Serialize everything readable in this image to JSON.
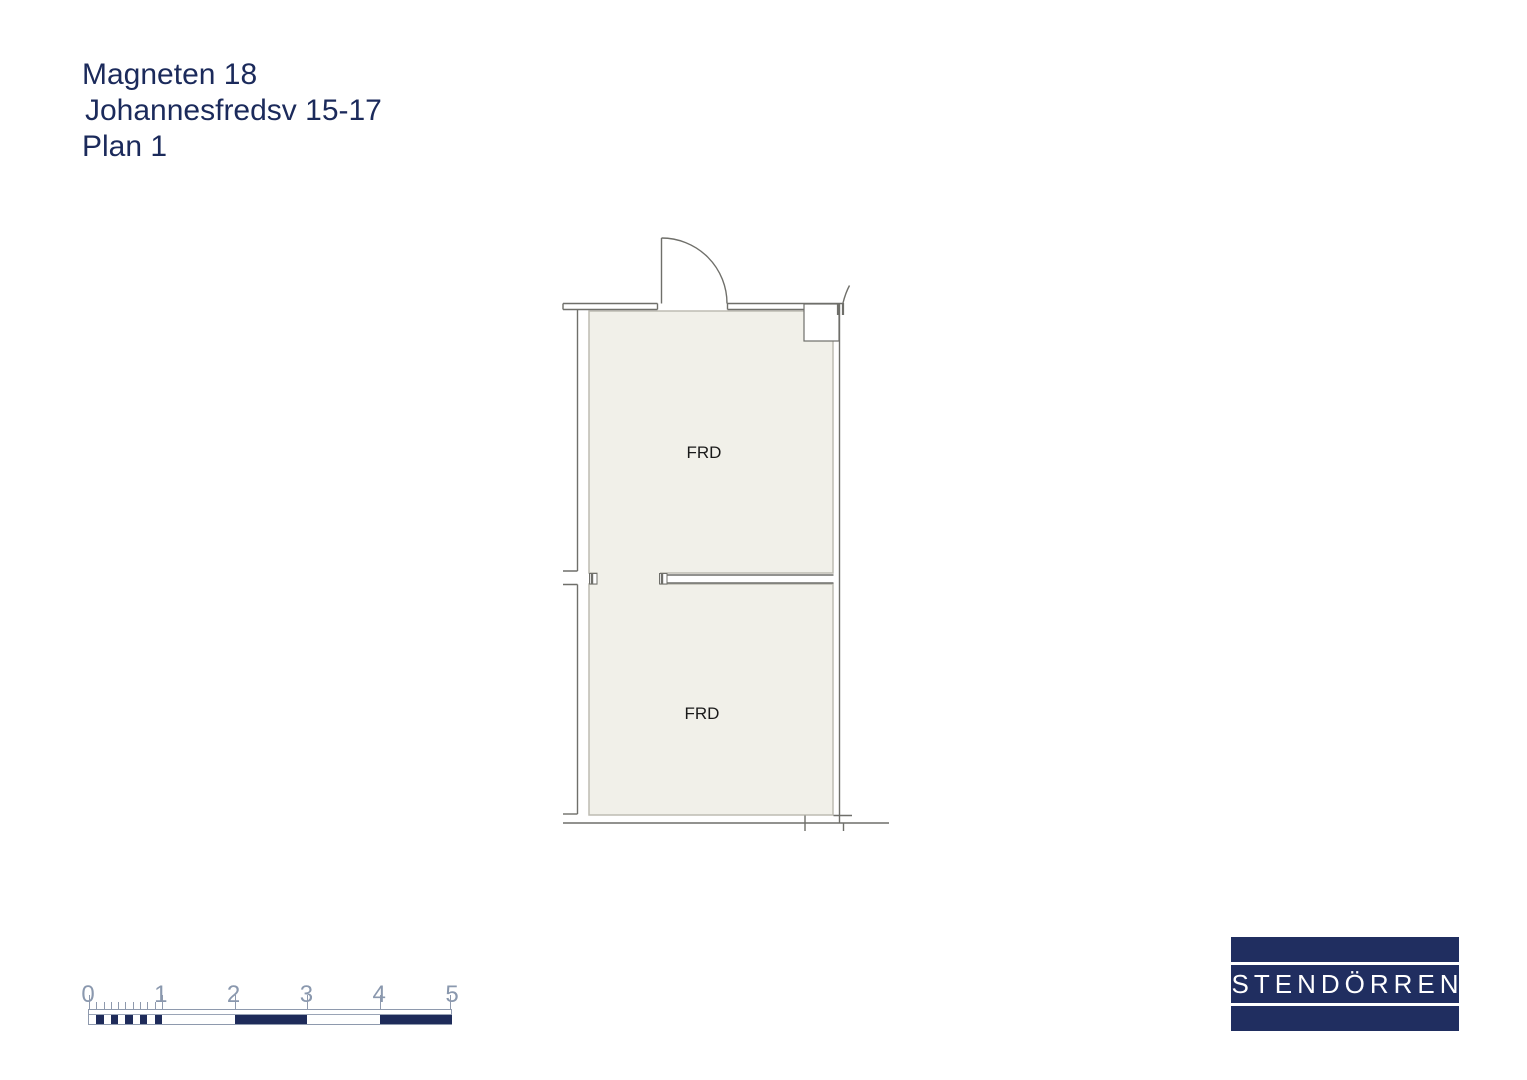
{
  "document": {
    "title_lines": [
      "Magneten 18",
      "Johannesfredsv 15-17",
      "Plan 1"
    ],
    "title_color": "#1b2a5b"
  },
  "floorplan": {
    "rooms": [
      {
        "label": "FRD"
      },
      {
        "label": "FRD"
      }
    ],
    "fill_color": "#f1f0e9",
    "wall_color": "#6f6f6a"
  },
  "scale_bar": {
    "labels": [
      "0",
      "1",
      "2",
      "3",
      "4",
      "5"
    ],
    "fill_color": "#1e2b5a",
    "tick_color": "#8e99ad",
    "label_color": "#8a98ae"
  },
  "logo": {
    "text": "STENDÖRREN",
    "background": "#202e60",
    "text_color": "#ffffff"
  }
}
